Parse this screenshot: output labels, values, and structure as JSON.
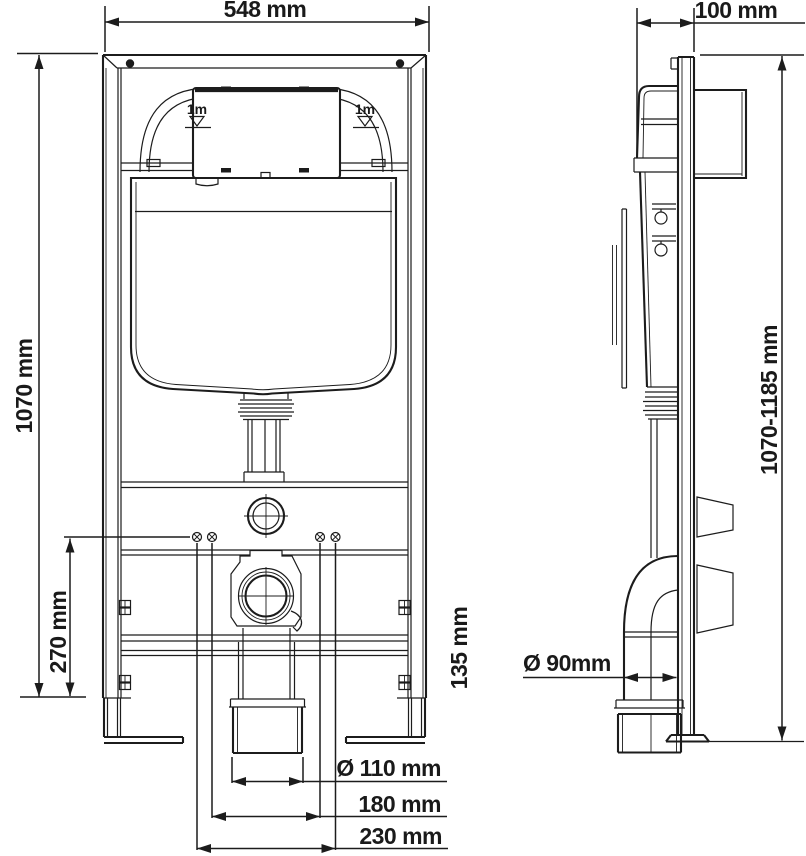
{
  "drawing": {
    "type": "installation-diagram",
    "subject": "concealed-cistern-wc-frame",
    "line_color": "#1c1c1c",
    "background": "#ffffff"
  },
  "labels": {
    "width_548": "548 mm",
    "depth_100": "100 mm",
    "height_1070": "1070 mm",
    "stud_height_270": "270 mm",
    "foot_135": "135 mm",
    "outlet_dia_110": "Ø 110 mm",
    "spacing_180": "180 mm",
    "spacing_230": "230 mm",
    "height_range": "1070-1185 mm",
    "drain_dia_90": "Ø 90mm",
    "level_mark": "1m"
  }
}
